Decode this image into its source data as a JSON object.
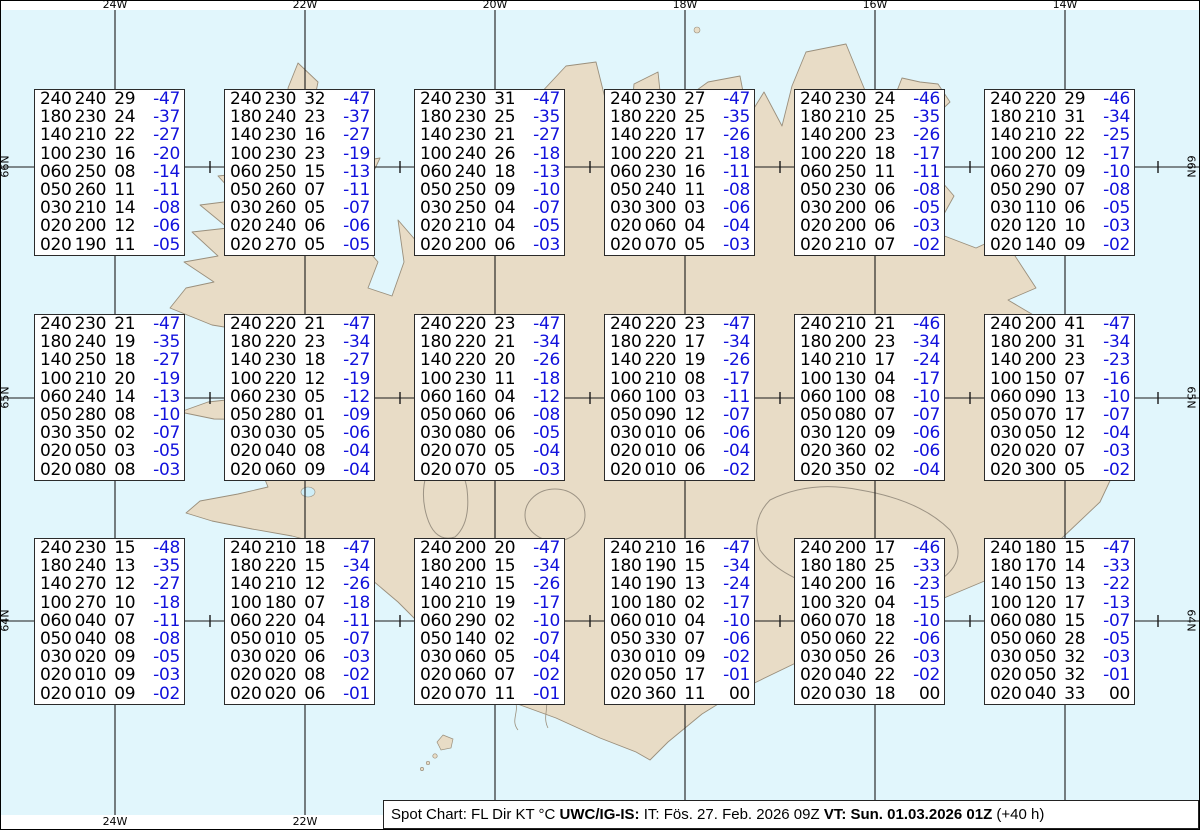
{
  "colors": {
    "ocean": "#e1f6fc",
    "land": "#e8dcc6",
    "coast": "#9a8f7c",
    "grid": "#1a1a1a",
    "temp_blue": "#1111dd",
    "glacier_outline": "#9c9384",
    "lake": "#cfeef7"
  },
  "caption": {
    "segments": [
      {
        "text": "Spot Chart: FL Dir KT °C ",
        "bold": false
      },
      {
        "text": "UWC/IG-IS:",
        "bold": true
      },
      {
        "text": " IT: Fös. 27. Feb. 2026 09Z ",
        "bold": false
      },
      {
        "text": "VT: Sun. 01.03.2026 01Z",
        "bold": true
      },
      {
        "text": " (+40 h)",
        "bold": false
      }
    ]
  },
  "chart_data": {
    "type": "table",
    "title": "Spot Chart: FL Dir KT °C",
    "columns": [
      "FL",
      "Dir",
      "KT",
      "TempC"
    ],
    "issue_time": "IT: Fös. 27. Feb. 2026 09Z",
    "valid_time": "VT: Sun. 01.03.2026 01Z (+40 h)",
    "lead": "+40 h",
    "axes": {
      "lon": [
        {
          "label": "24W",
          "x": 115
        },
        {
          "label": "22W",
          "x": 305
        },
        {
          "label": "20W",
          "x": 495
        },
        {
          "label": "18W",
          "x": 685
        },
        {
          "label": "16W",
          "x": 875
        },
        {
          "label": "14W",
          "x": 1065
        }
      ],
      "lat": [
        {
          "label": "66N",
          "y": 167
        },
        {
          "label": "65N",
          "y": 398
        },
        {
          "label": "64N",
          "y": 621
        }
      ],
      "marker_lons": [
        "23W",
        "21W",
        "19W",
        "17W",
        "15W",
        "13W"
      ]
    },
    "stations": [
      {
        "lat": "66N",
        "lon": "23W",
        "lines": [
          "240240 29 -47",
          "180230 24 -37",
          "140210 22 -27",
          "100230 16 -20",
          "060250 08 -14",
          "050260 11 -11",
          "030210 14 -08",
          "020200 12 -06",
          "020190 11 -05"
        ]
      },
      {
        "lat": "66N",
        "lon": "21W",
        "lines": [
          "240230 32 -47",
          "180240 23 -37",
          "140230 16 -27",
          "100230 23 -19",
          "060250 15 -13",
          "050260 07 -11",
          "030260 05 -07",
          "020240 06 -06",
          "020270 05 -05"
        ]
      },
      {
        "lat": "66N",
        "lon": "19W",
        "lines": [
          "240230 31 -47",
          "180230 25 -35",
          "140230 21 -27",
          "100240 26 -18",
          "060240 18 -13",
          "050250 09 -10",
          "030250 04 -07",
          "020210 04 -05",
          "020200 06 -03"
        ]
      },
      {
        "lat": "66N",
        "lon": "17W",
        "lines": [
          "240230 27 -47",
          "180220 25 -35",
          "140220 17 -26",
          "100220 21 -18",
          "060230 16 -11",
          "050240 11 -08",
          "030300 03 -06",
          "020060 04 -04",
          "020070 05 -03"
        ]
      },
      {
        "lat": "66N",
        "lon": "15W",
        "lines": [
          "240230 24 -46",
          "180210 25 -35",
          "140200 23 -26",
          "100220 18 -17",
          "060250 11 -11",
          "050230 06 -08",
          "030200 06 -05",
          "020200 06 -03",
          "020210 07 -02"
        ]
      },
      {
        "lat": "66N",
        "lon": "13W",
        "lines": [
          "240220 29 -46",
          "180210 31 -34",
          "140210 22 -25",
          "100200 12 -17",
          "060270 09 -10",
          "050290 07 -08",
          "030110 06 -05",
          "020120 10 -03",
          "020140 09 -02"
        ]
      },
      {
        "lat": "65N",
        "lon": "23W",
        "lines": [
          "240230 21 -47",
          "180240 19 -35",
          "140250 18 -27",
          "100210 20 -19",
          "060240 14 -13",
          "050280 08 -10",
          "030350 02 -07",
          "020050 03 -05",
          "020080 08 -03"
        ]
      },
      {
        "lat": "65N",
        "lon": "21W",
        "lines": [
          "240220 21 -47",
          "180220 23 -34",
          "140230 18 -27",
          "100220 12 -19",
          "060230 05 -12",
          "050280 01 -09",
          "030030 05 -06",
          "020040 08 -04",
          "020060 09 -04"
        ]
      },
      {
        "lat": "65N",
        "lon": "19W",
        "lines": [
          "240220 23 -47",
          "180220 21 -34",
          "140220 20 -26",
          "100230 11 -18",
          "060160 04 -12",
          "050060 06 -08",
          "030080 06 -05",
          "020070 05 -04",
          "020070 05 -03"
        ]
      },
      {
        "lat": "65N",
        "lon": "17W",
        "lines": [
          "240220 23 -47",
          "180220 17 -34",
          "140220 19 -26",
          "100210 08 -17",
          "060100 03 -11",
          "050090 12 -07",
          "030010 06 -06",
          "020010 06 -04",
          "020010 06 -02"
        ]
      },
      {
        "lat": "65N",
        "lon": "15W",
        "lines": [
          "240210 21 -46",
          "180200 23 -34",
          "140210 17 -24",
          "100130 04 -17",
          "060100 08 -10",
          "050080 07 -07",
          "030120 09 -06",
          "020360 02 -06",
          "020350 02 -04"
        ]
      },
      {
        "lat": "65N",
        "lon": "13W",
        "lines": [
          "240200 41 -47",
          "180200 31 -34",
          "140200 23 -23",
          "100150 07 -16",
          "060090 13 -10",
          "050070 17 -07",
          "030050 12 -04",
          "020020 07 -03",
          "020300 05 -02"
        ]
      },
      {
        "lat": "64N",
        "lon": "23W",
        "lines": [
          "240230 15 -48",
          "180240 13 -35",
          "140270 12 -27",
          "100270 10 -18",
          "060040 07 -11",
          "050040 08 -08",
          "030020 09 -05",
          "020010 09 -03",
          "020010 09 -02"
        ]
      },
      {
        "lat": "64N",
        "lon": "21W",
        "lines": [
          "240210 18 -47",
          "180220 15 -34",
          "140210 12 -26",
          "100180 07 -18",
          "060220 04 -11",
          "050010 05 -07",
          "030020 06 -03",
          "020020 08 -02",
          "020020 06 -01"
        ]
      },
      {
        "lat": "64N",
        "lon": "19W",
        "lines": [
          "240200 20 -47",
          "180200 15 -34",
          "140210 15 -26",
          "100210 19 -17",
          "060290 02 -10",
          "050140 02 -07",
          "030060 05 -04",
          "020060 07 -02",
          "020070 11 -01"
        ]
      },
      {
        "lat": "64N",
        "lon": "17W",
        "lines": [
          "240210 16 -47",
          "180190 15 -34",
          "140190 13 -24",
          "100180 02 -17",
          "060010 04 -10",
          "050330 07 -06",
          "030010 09 -02",
          "020050 17 -01",
          "020360 11  00"
        ]
      },
      {
        "lat": "64N",
        "lon": "15W",
        "lines": [
          "240200 17 -46",
          "180180 25 -33",
          "140200 16 -23",
          "100320 04 -15",
          "060070 18 -10",
          "050060 22 -06",
          "030050 26 -03",
          "020040 22 -02",
          "020030 18  00"
        ]
      },
      {
        "lat": "64N",
        "lon": "13W",
        "lines": [
          "240180 15 -47",
          "180170 14 -33",
          "140150 13 -22",
          "100120 17 -13",
          "060080 15 -07",
          "050060 28 -05",
          "030050 32 -03",
          "020050 32 -01",
          "020040 33  00"
        ]
      }
    ]
  }
}
